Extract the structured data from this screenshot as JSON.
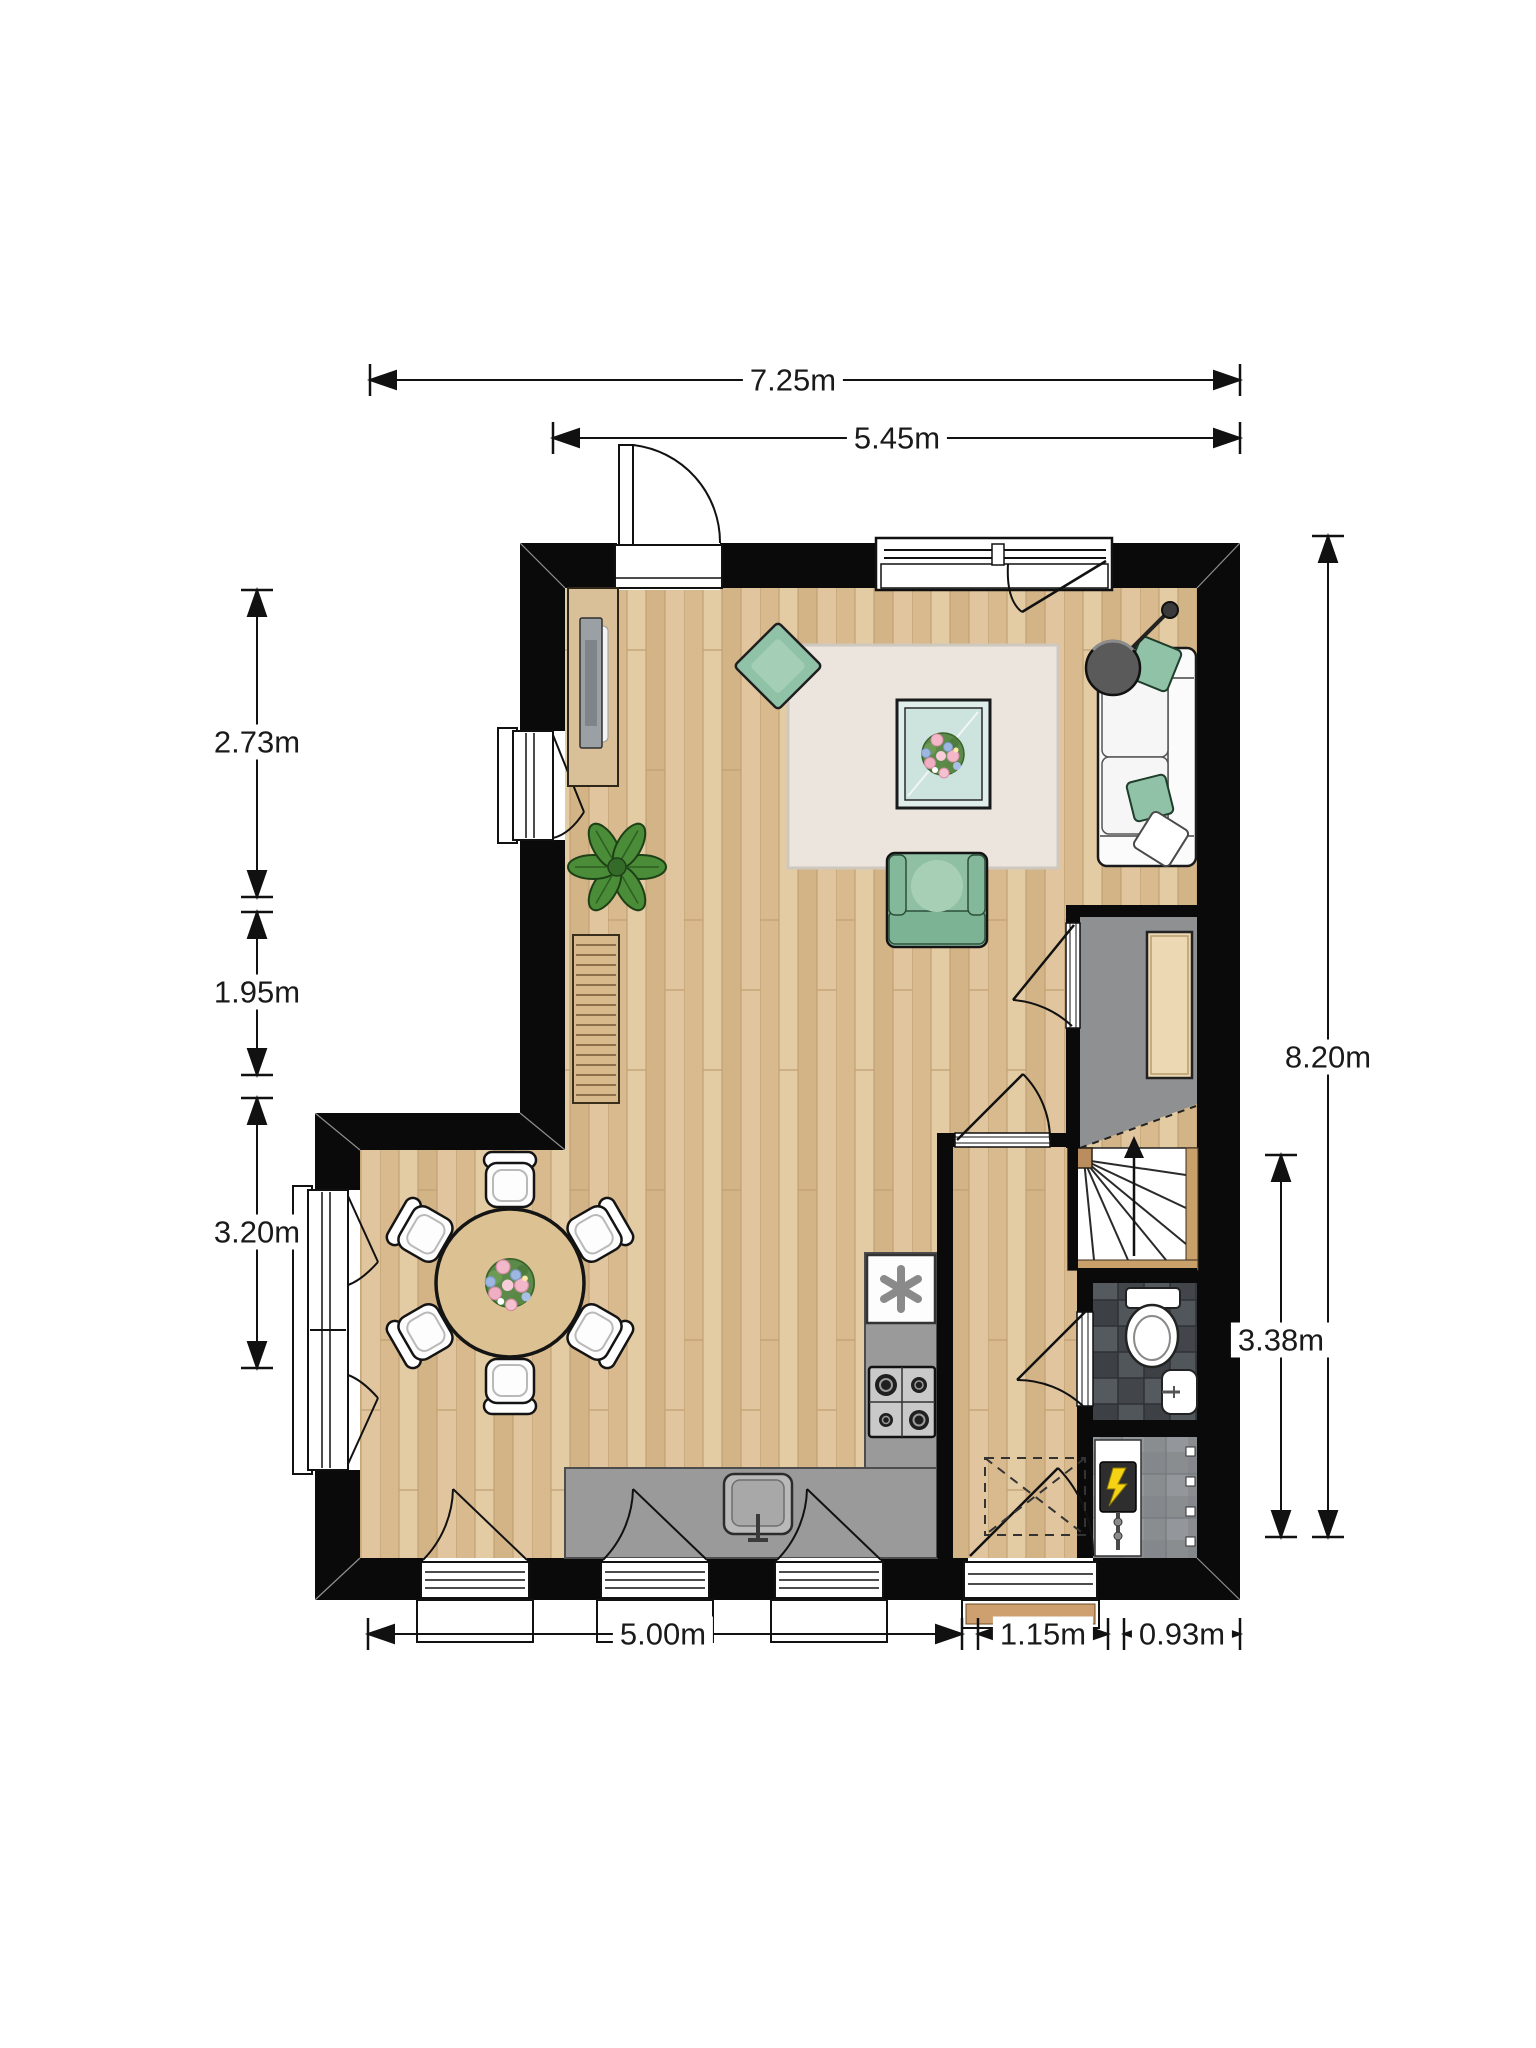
{
  "title": "floor-plan",
  "dimensions": {
    "top_overall": "7.25m",
    "top_living": "5.45m",
    "left_upper": "2.73m",
    "left_middle": "1.95m",
    "left_lower": "3.20m",
    "right_overall": "8.20m",
    "right_lower": "3.38m",
    "bottom_kitchen": "5.00m",
    "bottom_hall": "1.15m",
    "bottom_meter": "0.93m"
  },
  "colors": {
    "wall": "#0a0a0a",
    "wood_floor": "#dfc49c",
    "hall_floor_gray": "#8f9092",
    "counter_gray": "#9a9a9a",
    "bathroom_tile": "#464a4e",
    "rug": "#ebe5de",
    "accent_green": "#8fc2a6",
    "furniture_tan": "#dcc193",
    "dimension_line": "#111111"
  }
}
